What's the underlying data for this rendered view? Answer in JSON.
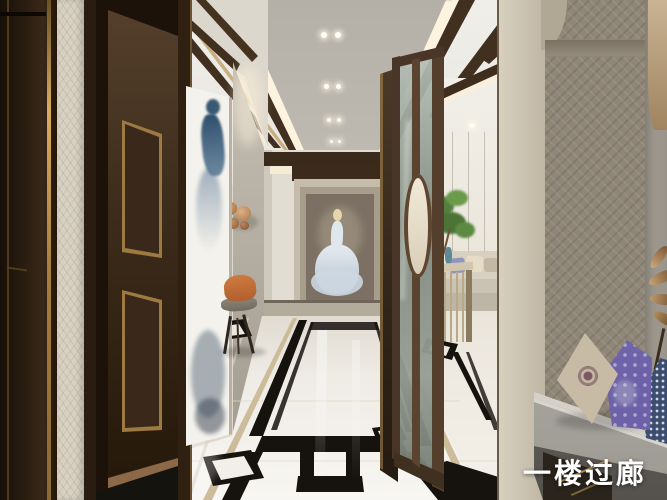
{
  "caption": {
    "text": "一楼过廊"
  },
  "scene": {
    "type": "interior-architectural-rendering",
    "room_label": "一楼过廊",
    "elements": [
      "dark-walnut-entry-door",
      "greek-key-wallpaper",
      "ink-figure-artwork",
      "bride-painting-end-wall",
      "glass-screen-partition-with-oval-ring",
      "living-room-sofa",
      "bonsai-plant",
      "console-table",
      "orange-accent-chair",
      "copper-disc-sconces",
      "marble-floor-black-inlay-runner",
      "ceiling-tray-with-spotlights",
      "bench-with-brocade-pillows"
    ]
  },
  "palette": {
    "wood_dark": "#33251a",
    "gold_trim": "#c9a253",
    "wallpaper_cream": "#d8d1c2",
    "wall_greige": "#d7d2c7",
    "ceiling_tray": "#c2beb6",
    "floor_marble": "#f2efe9",
    "floor_inlay_black": "#16120e",
    "screen_glass": "#929a8e",
    "accent_orange": "#c4703a",
    "plant_green": "#55813f",
    "pillow_teal": "#44606a",
    "pillow_purple": "#7a6fb5",
    "pillow_navy": "#3d4d6f",
    "painting_dress_blue": "#c9d4dd",
    "caption_color": "#ffffff"
  }
}
